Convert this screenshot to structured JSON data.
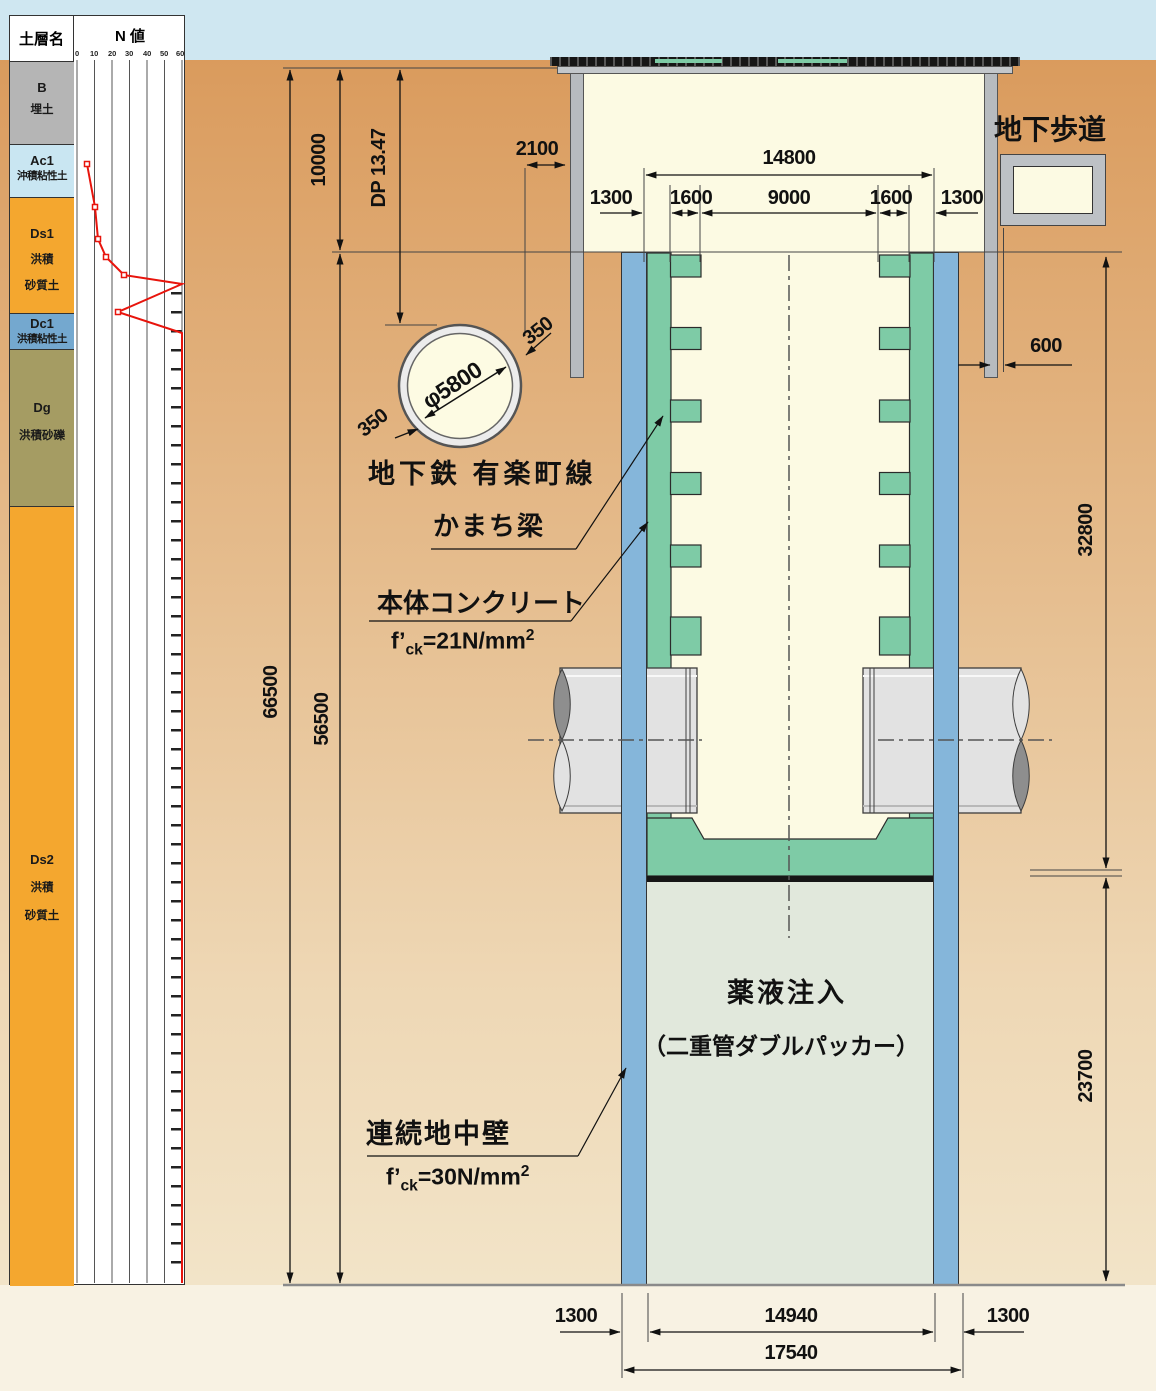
{
  "soil_column": {
    "header_layer": "土層名",
    "header_n": "N 値",
    "n_ticks": [
      "0",
      "10",
      "20",
      "30",
      "40",
      "50",
      "60"
    ],
    "layers": [
      {
        "code": "B",
        "lines": [
          "埋土"
        ],
        "color": "#b5b5b5"
      },
      {
        "code": "Ac1",
        "lines": [
          "沖積粘性土"
        ],
        "color": "#c9e6f2"
      },
      {
        "code": "Ds1",
        "lines": [
          "洪積",
          "砂質土"
        ],
        "color": "#f4a72f"
      },
      {
        "code": "Dc1",
        "lines": [
          "洪積粘性土"
        ],
        "color": "#74a8cf"
      },
      {
        "code": "Dg",
        "lines": [
          "洪積砂礫"
        ],
        "color": "#a59c63"
      },
      {
        "code": "Ds2",
        "lines": [
          "洪積",
          "砂質土"
        ],
        "color": "#f4a72f"
      }
    ]
  },
  "chart_data": {
    "type": "line",
    "title": "N 値 (SPT N-value vs depth)",
    "xlabel": "N 値",
    "ylabel": "depth (drawing px)",
    "x_range": [
      0,
      60
    ],
    "x_ticks": [
      0,
      10,
      20,
      30,
      40,
      50,
      60
    ],
    "series": [
      {
        "name": "N値",
        "points": [
          {
            "depth_px": 164,
            "n": 6
          },
          {
            "depth_px": 207,
            "n": 10
          },
          {
            "depth_px": 239,
            "n": 12
          },
          {
            "depth_px": 257,
            "n": 17
          },
          {
            "depth_px": 275,
            "n": 27
          },
          {
            "depth_px": 284,
            "n": 60
          },
          {
            "depth_px": 312,
            "n": 23
          },
          {
            "depth_px": 333,
            "n": 60
          },
          {
            "depth_px": 1283,
            "n": 60
          }
        ]
      }
    ],
    "note": "N>60 below Dc1 layer: line clipped at 60 with tick marks",
    "polyline_px": "87,164 95,207 98,239 106,257 124,275 182,284 118,312 182,333 182,1283",
    "marker_px": [
      [
        87,
        164
      ],
      [
        95,
        207
      ],
      [
        98,
        239
      ],
      [
        106,
        257
      ],
      [
        124,
        275
      ],
      [
        118,
        312
      ]
    ],
    "line_color": "#e8140c"
  },
  "dims": {
    "v66500": "66500",
    "v56500": "56500",
    "v10000": "10000",
    "dp": "DP 13.47",
    "h2100": "2100",
    "h14800": "14800",
    "h1300l": "1300",
    "h1600l": "1600",
    "h9000": "9000",
    "h1600r": "1600",
    "h1300r": "1300",
    "h600": "600",
    "v32800": "32800",
    "v23700": "23700",
    "b1300l": "1300",
    "b14940": "14940",
    "b1300r": "1300",
    "b17540": "17540",
    "phi": "φ5800",
    "t350a": "350",
    "t350b": "350"
  },
  "labels": {
    "walkway": "地下歩道",
    "subway": "地下鉄 有楽町線",
    "kamachi": "かまち梁",
    "body_concrete": "本体コンクリート",
    "spec21": {
      "f": "f’",
      "sub": "ck",
      "rest": "=21N/mm",
      "sup": "2"
    },
    "wall": "連続地中壁",
    "spec30": {
      "f": "f’",
      "sub": "ck",
      "rest": "=30N/mm",
      "sup": "2"
    },
    "grout_line1": "薬液注入",
    "grout_line2": "（二重管ダブルパッカー）"
  },
  "colors": {
    "sky": "#cfe7f1",
    "ground_top": "#da9b5d",
    "ground_bottom": "#f2e4c8",
    "below_ground": "#f8f2e3",
    "wall_blue": "#85b6da",
    "lining_green": "#7ecba6",
    "interior_cream": "#fcfae3",
    "injection": "#e1e8dc",
    "pipe_gray": "#e2e2e2",
    "deck_gray": "#c3c7cb",
    "post_gray": "#b7bbbf",
    "n_line_red": "#e8140c"
  }
}
